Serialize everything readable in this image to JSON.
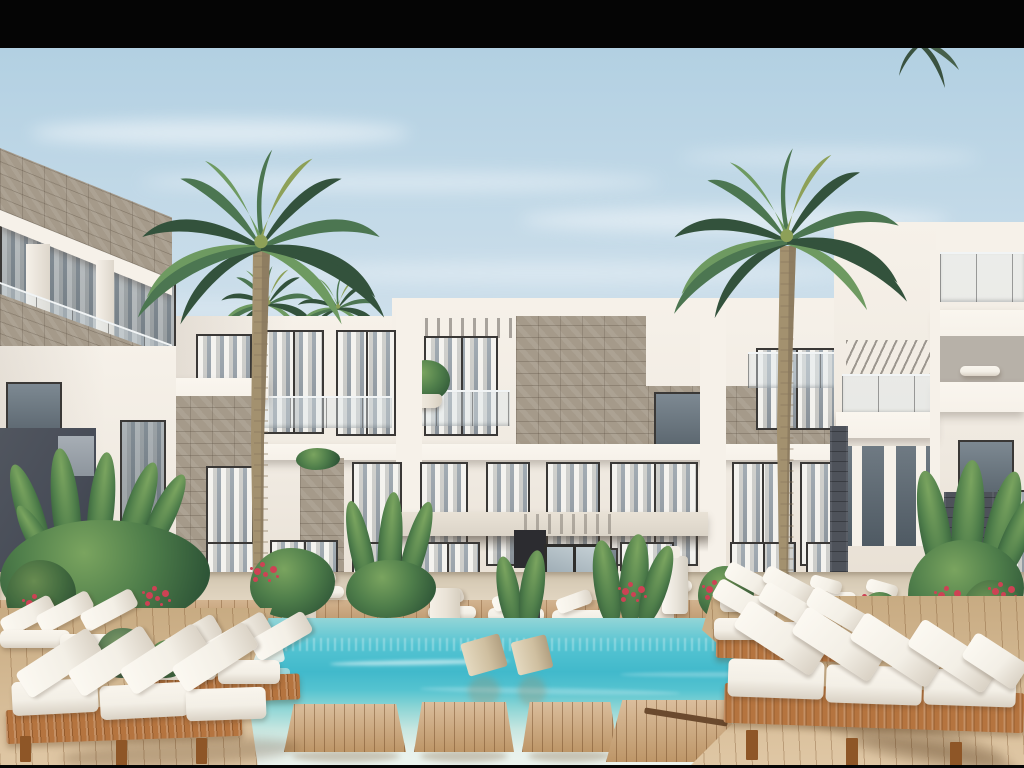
{
  "meta": {
    "description": "Sunny 3D architectural rendering of a modern white resort apartment complex: three-storey buildings with stone accents and glass balconies around a turquoise swimming pool with wooden swim platforms, white cushioned sun loungers on timber decks, tropical plants with red flowers and two tall palm trees; photo letterboxed with black bars",
    "image_type": "architectural exterior render, no text or UI elements"
  },
  "palette": {
    "black_bar": "#050505",
    "sky_top": "#b2d0e2",
    "sky_mid": "#cddfeb",
    "sky_horizon": "#e4edf2",
    "wall_light": "#f6f1e9",
    "wall": "#efe9e0",
    "wall_warm": "#e6ddd0",
    "wall_shadow": "#cfc8bd",
    "stone": "#a59a8a",
    "slate": "#4e525a",
    "navy": "#474c57",
    "glass": "#76828d",
    "glass_light": "#9fadb8",
    "frame": "#3a3836",
    "canopy": "#dbd4c8",
    "pavement": "#d9cdb8",
    "deck_wood": "#c49a6a",
    "deck_light": "#d7b88c",
    "lounger_wood": "#b5743f",
    "lounger_wood_dark": "#8e5627",
    "cushion": "#f3efe6",
    "cushion_shadow": "#d9d1c4",
    "water_far": "#93d5d7",
    "water_mid": "#55c4d2",
    "water_deep": "#41b9cb",
    "water_near": "#c6e6e0",
    "water_pale": "#e8f2ed",
    "palm_dark": "#33523c",
    "palm_mid": "#4c7651",
    "palm_light": "#6e9a61",
    "palm_yellow": "#8da058",
    "trunk": "#a3916f",
    "trunk_dark": "#7e6d55",
    "leaf_dark": "#2e5537",
    "leaf_mid": "#4e7d4a",
    "leaf_light": "#7aa45f",
    "flower": "#cd4254",
    "pot": "#e9e2d6"
  },
  "scene": {
    "sky": {
      "label": "clear blue sky with wispy white clouds"
    },
    "buildings": {
      "center": {
        "label": "central three-storey white apartment building with stone-clad accents, glass balcony railings, pergola details and a canopied entrance",
        "floors": 3
      },
      "left_wing": {
        "label": "left wing building with chequered stone balcony bands, white columns and a dark blue-grey wall panel"
      },
      "right_wing": {
        "label": "right wing building with stacked white balcony slabs, pergola and dark slate stone piers"
      }
    },
    "palms": {
      "label": "palm trees",
      "tall": 2,
      "small_background": 5
    },
    "pool": {
      "label": "turquoise resort swimming pool with wooden coping, four floating timber platforms and submerged beige loungers",
      "platforms": 4,
      "in_pool_features": 2
    },
    "furniture": {
      "label": "white cushioned timber sun loungers with slatted side tables",
      "foreground_lounger_groups": 2,
      "midground_loungers": 8,
      "side_tables": 11
    },
    "plants": {
      "label": "tropical planting with banana leaves, agaves and red flowering shrubs in white pots",
      "clusters": 9
    }
  }
}
